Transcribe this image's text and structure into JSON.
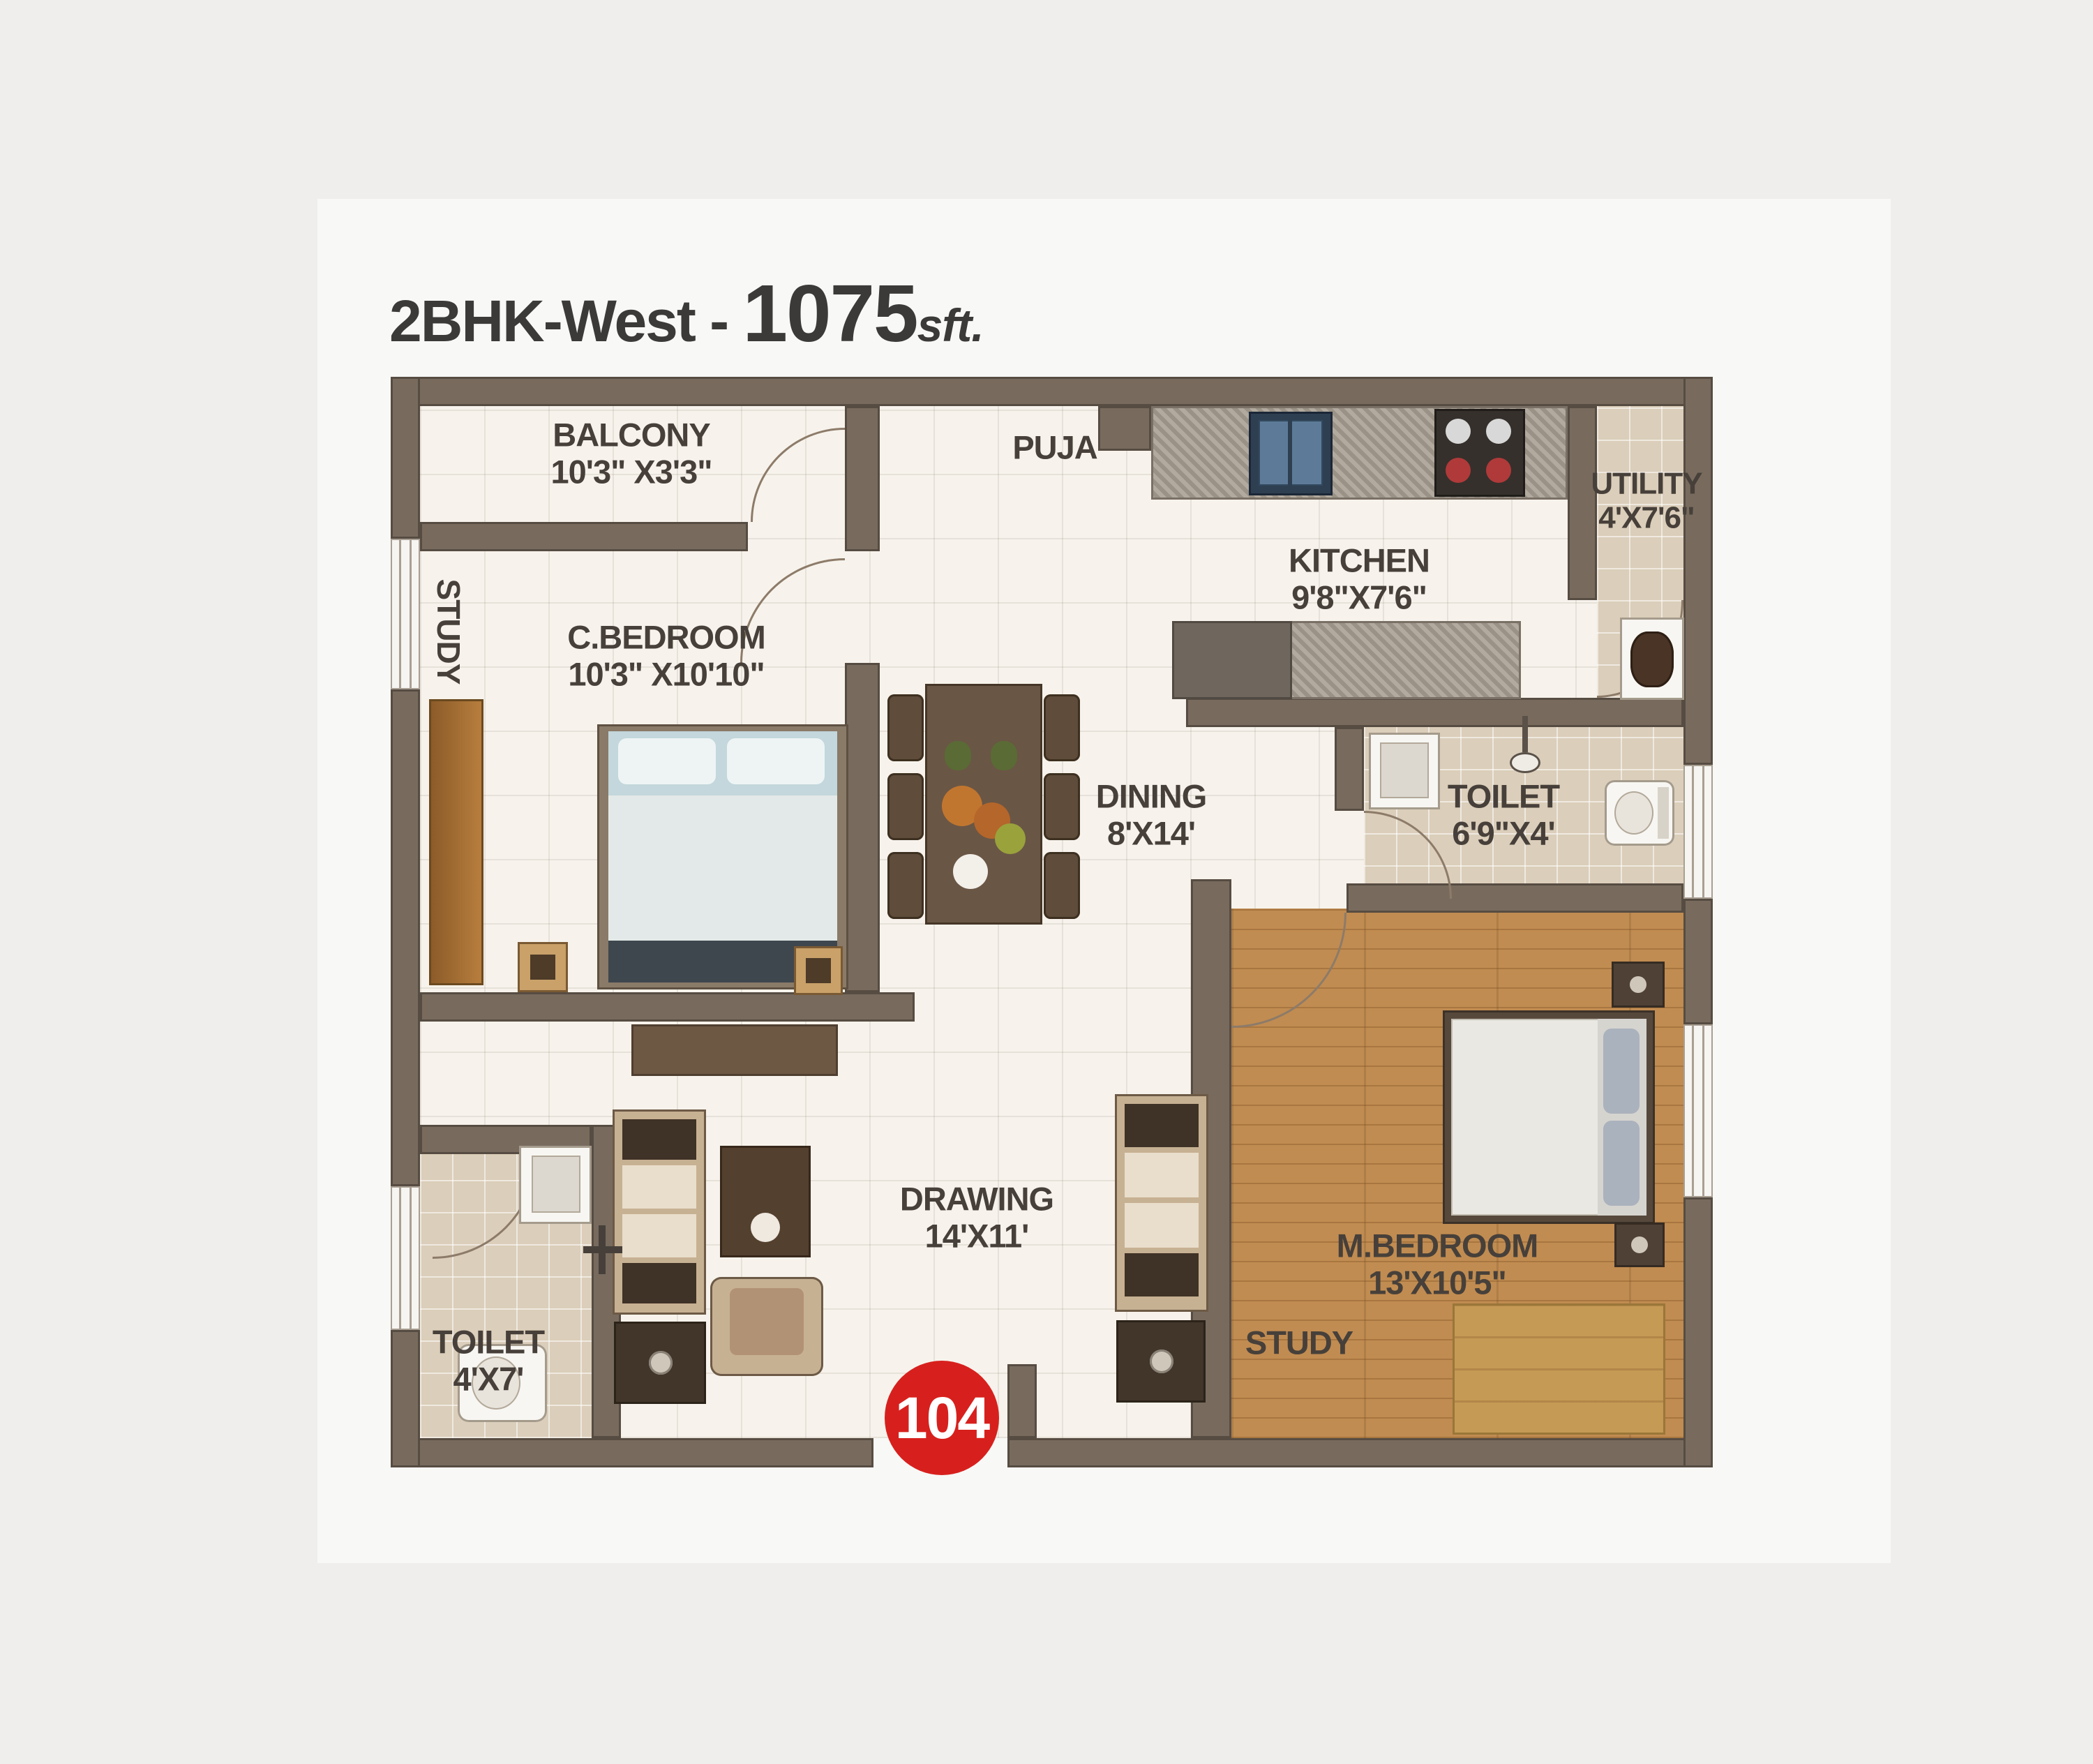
{
  "title": {
    "prefix": "2BHK-West - ",
    "area": "1075",
    "unit": "sft."
  },
  "badge": {
    "unit_number": "104"
  },
  "rooms": {
    "balcony": {
      "name": "BALCONY",
      "dims": "10'3\" X3'3\""
    },
    "study_nook": {
      "name": "STUDY"
    },
    "c_bedroom": {
      "name": "C.BEDROOM",
      "dims": "10'3\" X10'10\""
    },
    "puja": {
      "name": "PUJA"
    },
    "kitchen": {
      "name": "KITCHEN",
      "dims": "9'8\"X7'6\""
    },
    "utility": {
      "name": "UTILITY",
      "dims": "4'X7'6\""
    },
    "toilet_attached": {
      "name": "TOILET",
      "dims": "6'9\"X4'"
    },
    "dining": {
      "name": "DINING",
      "dims": "8'X14'"
    },
    "drawing": {
      "name": "DRAWING",
      "dims": "14'X11'"
    },
    "toilet_common": {
      "name": "TOILET",
      "dims": "4'X7'"
    },
    "m_bedroom": {
      "name": "M.BEDROOM",
      "dims": "13'X10'5\""
    },
    "study_corner": {
      "name": "STUDY"
    }
  },
  "colors": {
    "background": "#efeeec",
    "wall": "#786b5e",
    "wall_edge": "#574c42",
    "living_floor": "#f7f3ec",
    "tile_floor": "#dbceba",
    "wood_floor": "#c18c51",
    "badge_red": "#d7201d",
    "label_text": "#47403a"
  },
  "icons": {
    "kitchen_sink": "sink-icon",
    "hob": "stove-burners-icon",
    "utility_sink": "wash-basin-icon",
    "wash_basin": "wash-basin-icon",
    "shower": "shower-icon",
    "wc": "toilet-seat-icon",
    "double_bed": "bed-icon",
    "dining_table": "dining-table-icon",
    "sofa": "sofa-icon",
    "wardrobe": "wardrobe-icon"
  }
}
